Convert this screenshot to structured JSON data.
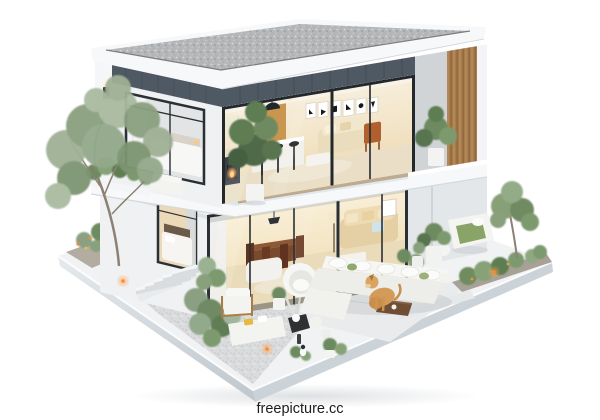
{
  "scene": {
    "subject": "3D cutaway render of a modern two-storey house on a floating landscaped platform"
  },
  "watermark": {
    "text": "freepicture.cc"
  },
  "colors": {
    "background": "#ffffff",
    "roofGravel": "#b5b7b9",
    "fascia": "#f7f8f9",
    "panelDark": "#4f5963",
    "wallWhite": "#eff1f3",
    "glassWarm": "#f4e9cf",
    "woodSlat": "#a87b4c",
    "deckWood": "#c59565",
    "platformTop": "#f0f2f3",
    "platformSide": "#ccd3d8",
    "gravel": "#d9dbdd",
    "paver": "#e9ebed",
    "foliage": "#8ba083",
    "foliageDark": "#5f7d52",
    "sofaWhite": "#f3f3f0",
    "sofaBeige": "#e5cfa4",
    "dogFur": "#d49a58",
    "warmLight": "#ffa04a",
    "frameDark": "#2b3036",
    "watermark": "#1c1c1c"
  }
}
